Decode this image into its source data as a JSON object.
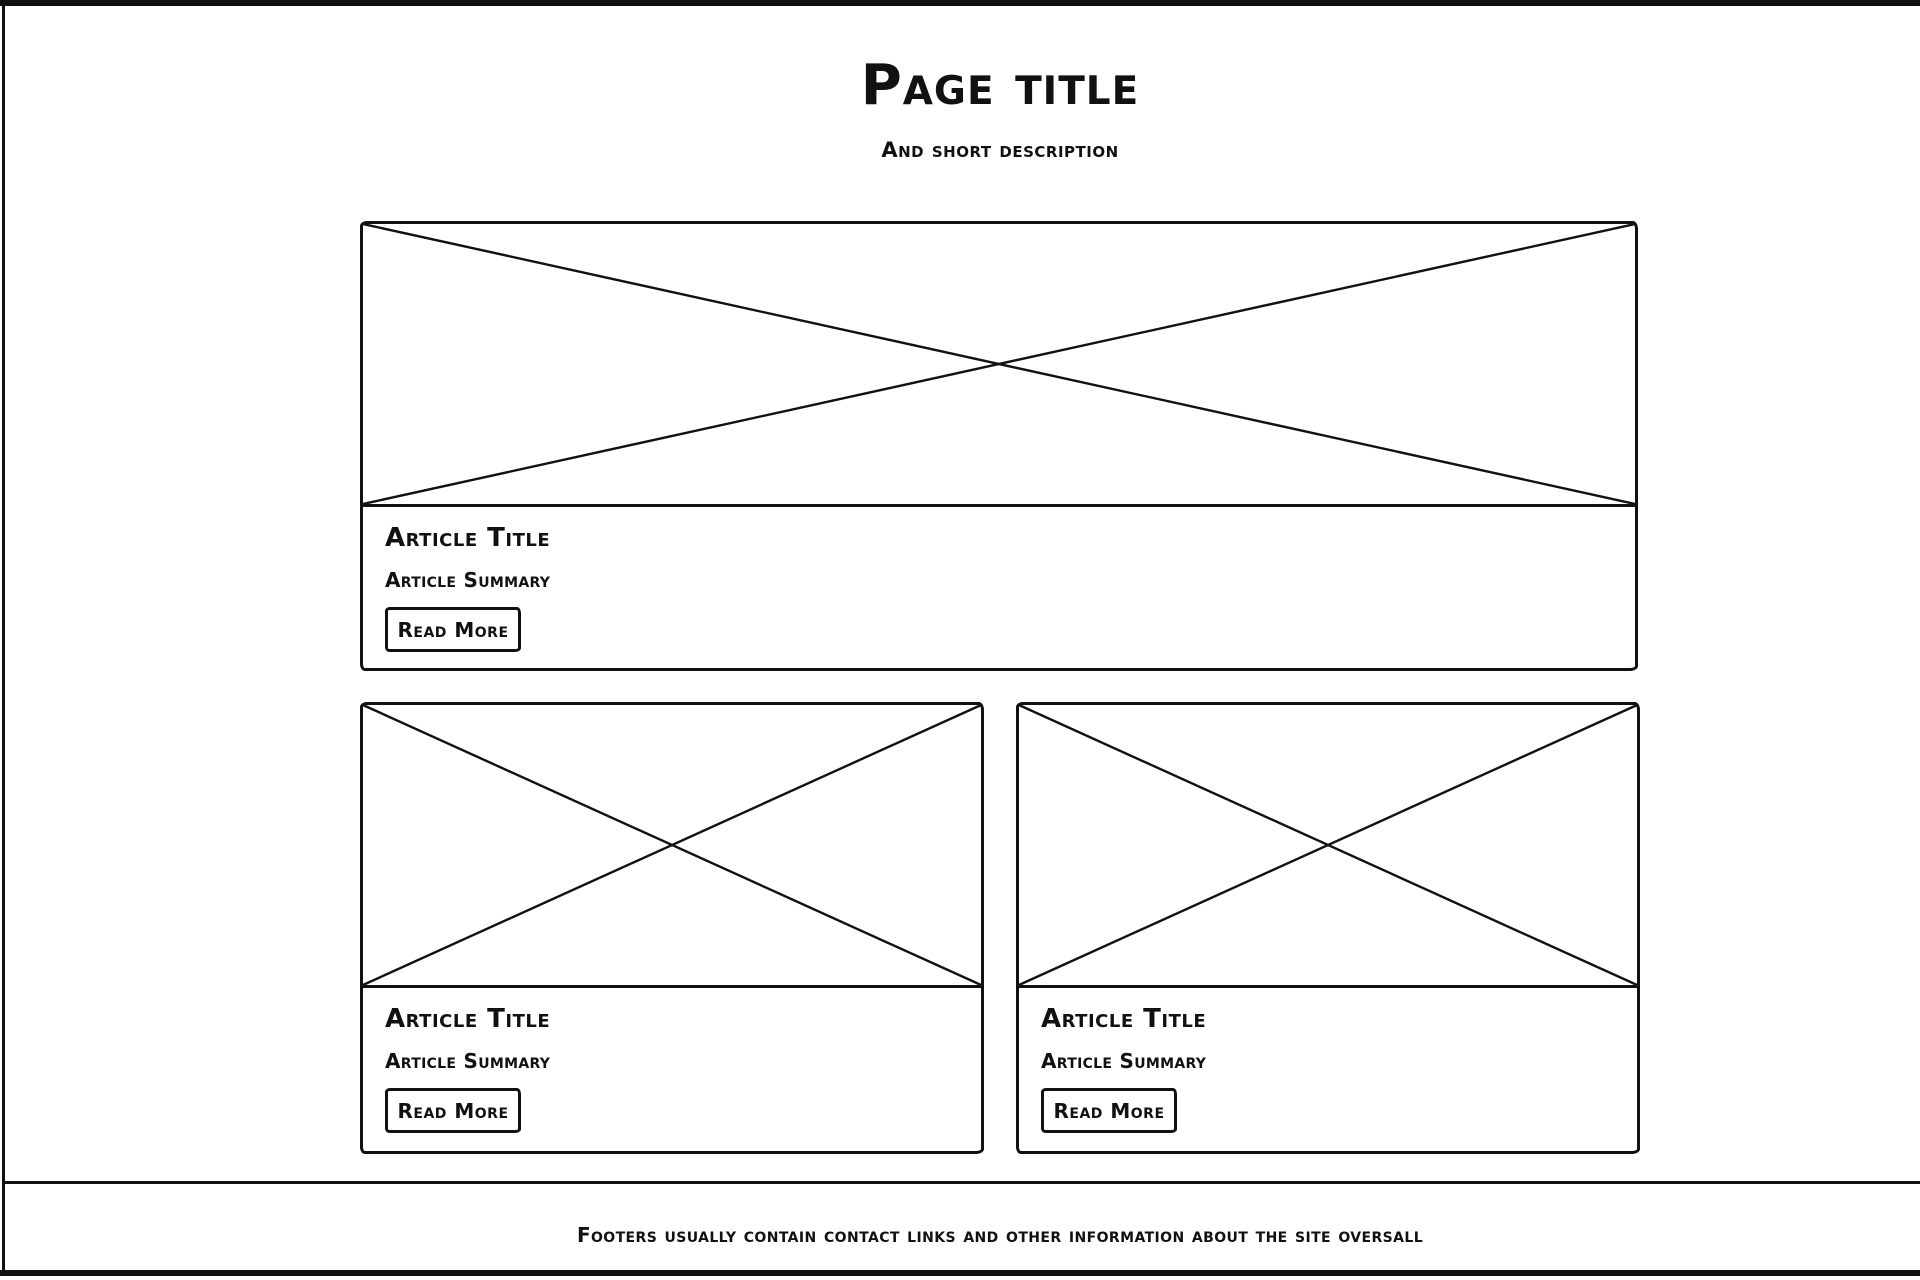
{
  "header": {
    "title": "Page title",
    "description": "And short description"
  },
  "articles": [
    {
      "title": "Article Title",
      "summary": "Article Summary",
      "button_label": "Read More"
    },
    {
      "title": "Article Title",
      "summary": "Article Summary",
      "button_label": "Read More"
    },
    {
      "title": "Article Title",
      "summary": "Article Summary",
      "button_label": "Read More"
    }
  ],
  "footer": {
    "text": "Footers usually contain contact links and other information about the site oversall"
  },
  "icons": {
    "image_placeholder": "crossed-box-image-placeholder"
  },
  "colors": {
    "ink": "#111111",
    "paper": "#ffffff"
  }
}
